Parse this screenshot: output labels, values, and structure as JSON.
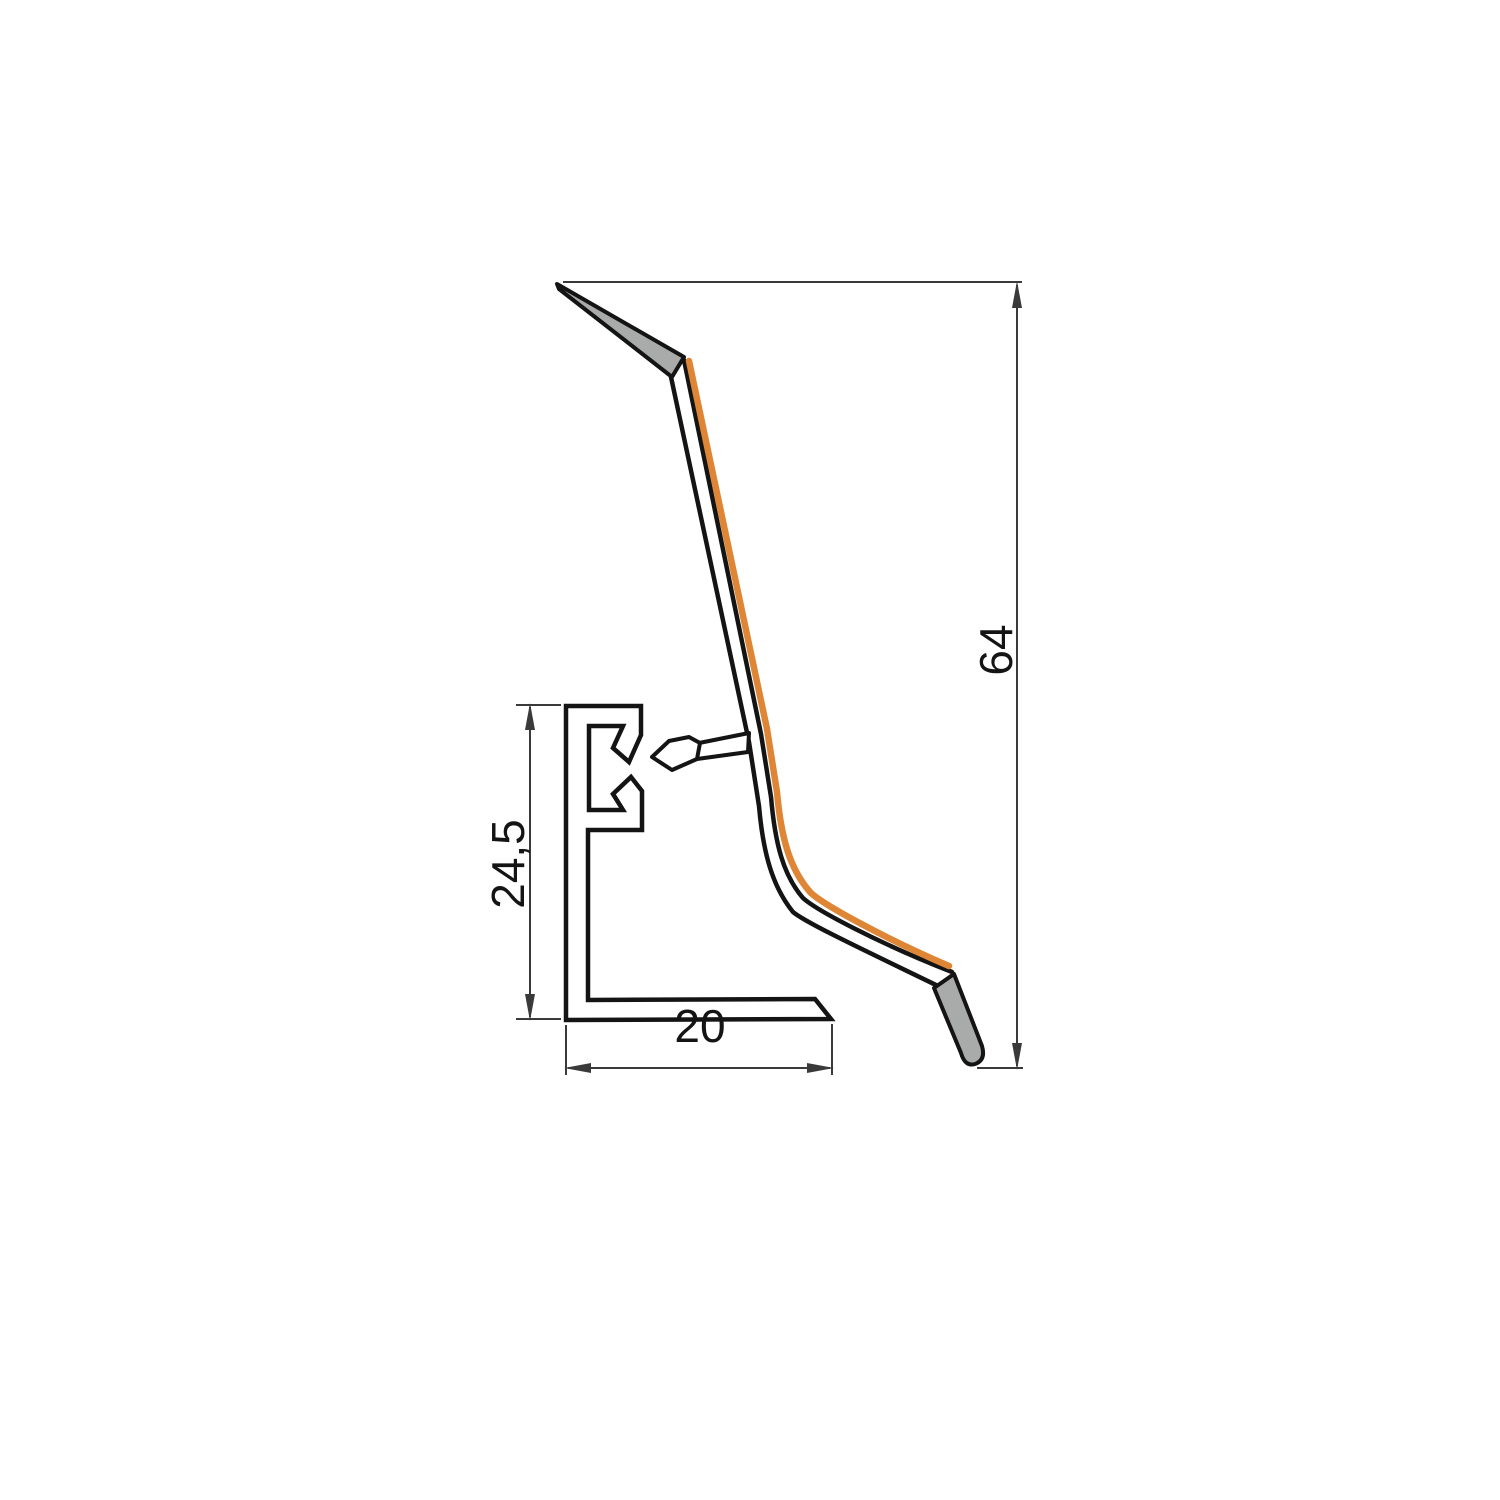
{
  "drawing": {
    "type": "skirting-profile-cross-section",
    "labels": {
      "total_height": "64",
      "rail_height": "24,5",
      "foot_width": "20"
    },
    "colors": {
      "outline": "#141414",
      "dimension": "#3a3a3a",
      "accent_orange": "#DE8636",
      "soft_lip_gray": "#a9abaa",
      "white_fill": "#ffffff",
      "text": "#141414",
      "background": "#ffffff"
    }
  }
}
